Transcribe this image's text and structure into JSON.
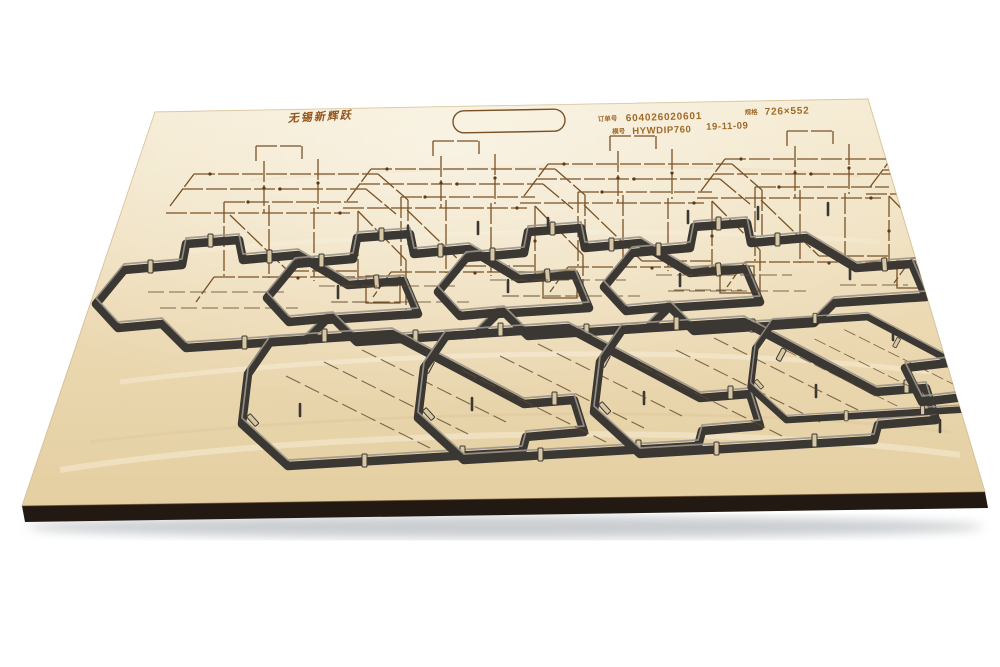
{
  "board_text": {
    "brand": "无锡新辉跃",
    "order_label": "订单号",
    "order_number": "604026020601",
    "size_label": "规格",
    "sheet_size": "726×552",
    "die_label": "模号",
    "die_code": "HYWDIP760",
    "date": "19-11-09"
  },
  "colors": {
    "wood_light": "#f2e6c8",
    "wood_dark": "#e6d2a8",
    "blade": "#3b3733",
    "blade_highlight": "#9b958b",
    "engrave": "#7a5226",
    "board_edge": "#221a12",
    "background": "#ffffff"
  }
}
